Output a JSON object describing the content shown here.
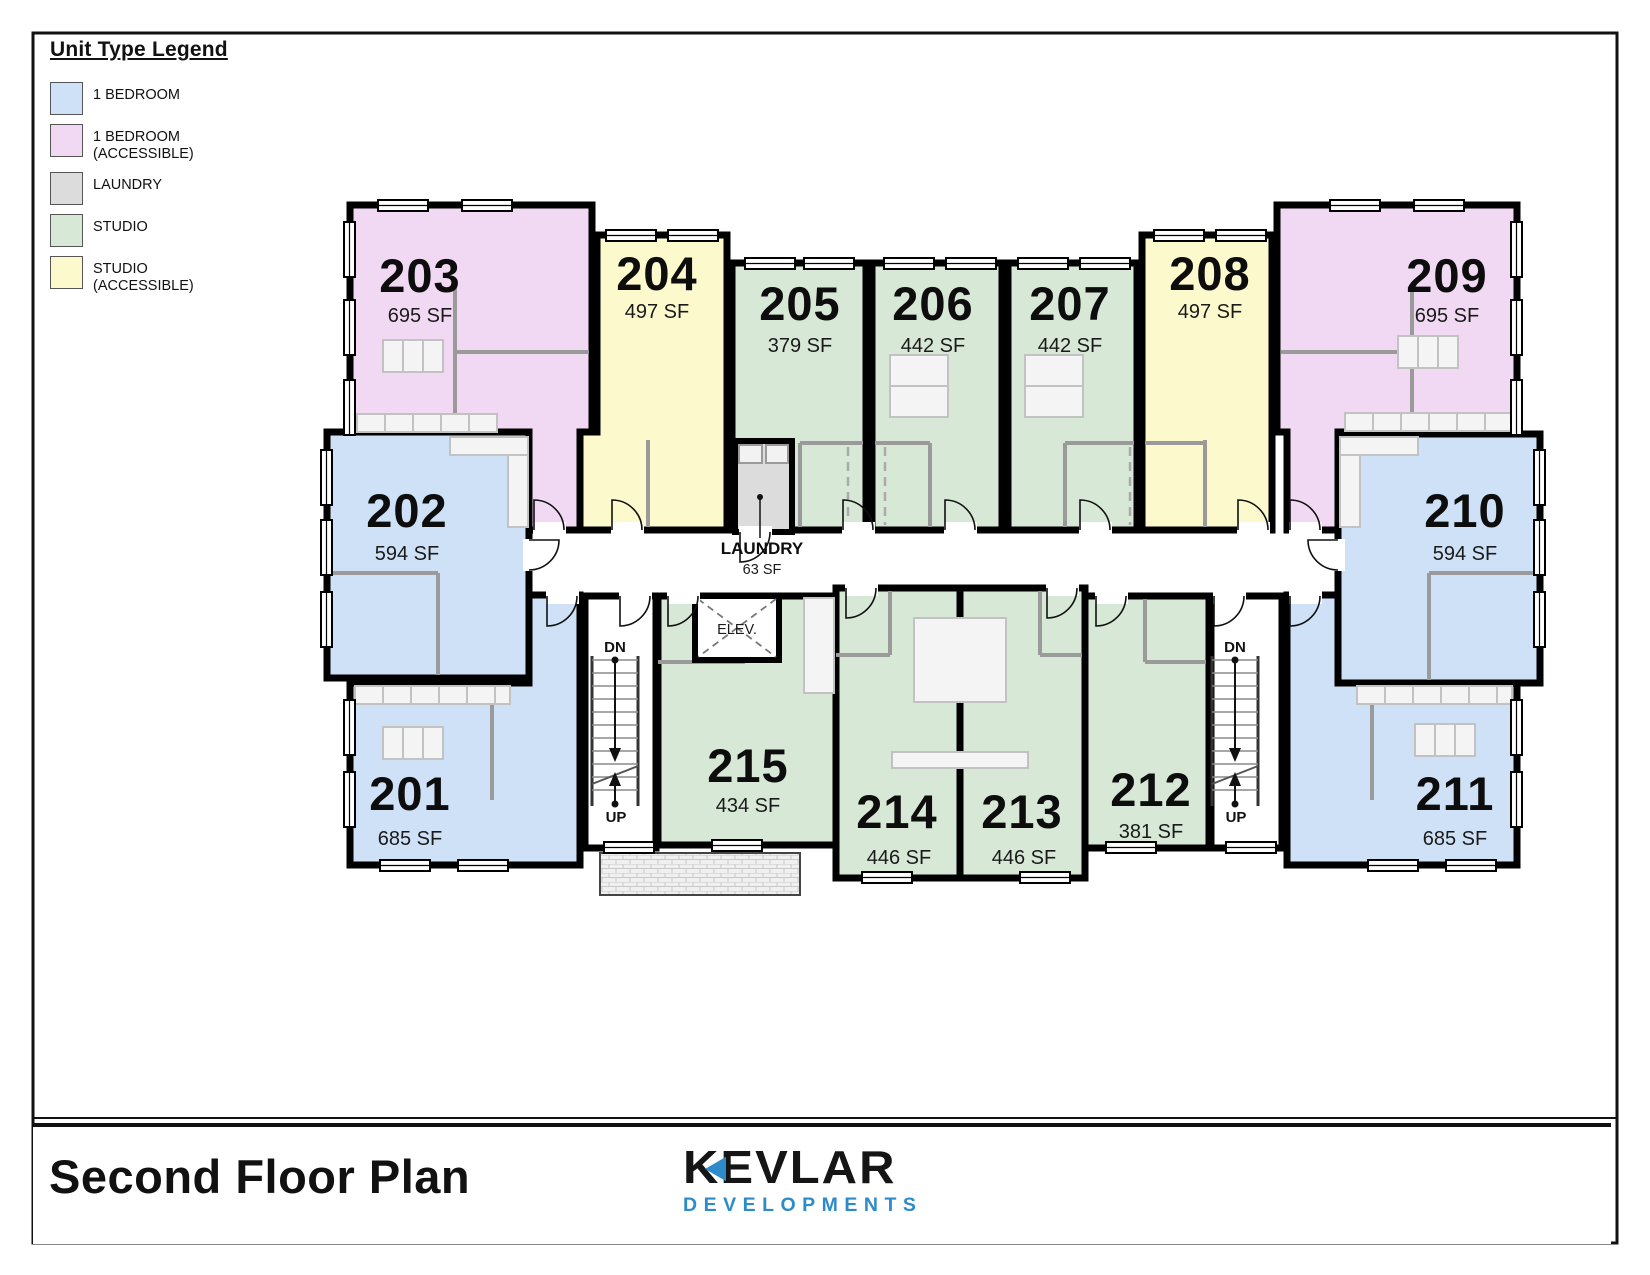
{
  "legend": {
    "title": "Unit Type Legend",
    "items": [
      {
        "label": "1 BEDROOM"
      },
      {
        "label": "1 BEDROOM\n(ACCESSIBLE)"
      },
      {
        "label": "LAUNDRY"
      },
      {
        "label": "STUDIO"
      },
      {
        "label": "STUDIO\n(ACCESSIBLE)"
      }
    ]
  },
  "colors": {
    "bedroom1": "#cfe1f6",
    "bedroom1_accessible": "#f2d9f3",
    "laundry": "#dcdcdc",
    "studio": "#d8e8d7",
    "studio_accessible": "#fcfacd",
    "wall": "#000000",
    "logo_blue": "#2e8bc9"
  },
  "units": {
    "201": {
      "number": "201",
      "area": "685 SF",
      "type": "1 BEDROOM"
    },
    "202": {
      "number": "202",
      "area": "594 SF",
      "type": "1 BEDROOM"
    },
    "203": {
      "number": "203",
      "area": "695 SF",
      "type": "1 BEDROOM (ACCESSIBLE)"
    },
    "204": {
      "number": "204",
      "area": "497 SF",
      "type": "STUDIO (ACCESSIBLE)"
    },
    "205": {
      "number": "205",
      "area": "379 SF",
      "type": "STUDIO"
    },
    "206": {
      "number": "206",
      "area": "442 SF",
      "type": "STUDIO"
    },
    "207": {
      "number": "207",
      "area": "442 SF",
      "type": "STUDIO"
    },
    "208": {
      "number": "208",
      "area": "497 SF",
      "type": "STUDIO (ACCESSIBLE)"
    },
    "209": {
      "number": "209",
      "area": "695 SF",
      "type": "1 BEDROOM (ACCESSIBLE)"
    },
    "210": {
      "number": "210",
      "area": "594 SF",
      "type": "1 BEDROOM"
    },
    "211": {
      "number": "211",
      "area": "685 SF",
      "type": "1 BEDROOM"
    },
    "212": {
      "number": "212",
      "area": "381 SF",
      "type": "STUDIO"
    },
    "213": {
      "number": "213",
      "area": "446 SF",
      "type": "STUDIO"
    },
    "214": {
      "number": "214",
      "area": "446 SF",
      "type": "STUDIO"
    },
    "215": {
      "number": "215",
      "area": "434 SF",
      "type": "STUDIO"
    }
  },
  "corridor": {
    "laundry_label": "LAUNDRY",
    "laundry_area": "63 SF",
    "elevator_label": "ELEV.",
    "stair_down_label": "DN",
    "stair_up_label": "UP"
  },
  "title_block": {
    "title": "Second Floor Plan",
    "logo_name": "KEVLAR",
    "logo_subtitle": "DEVELOPMENTS"
  }
}
